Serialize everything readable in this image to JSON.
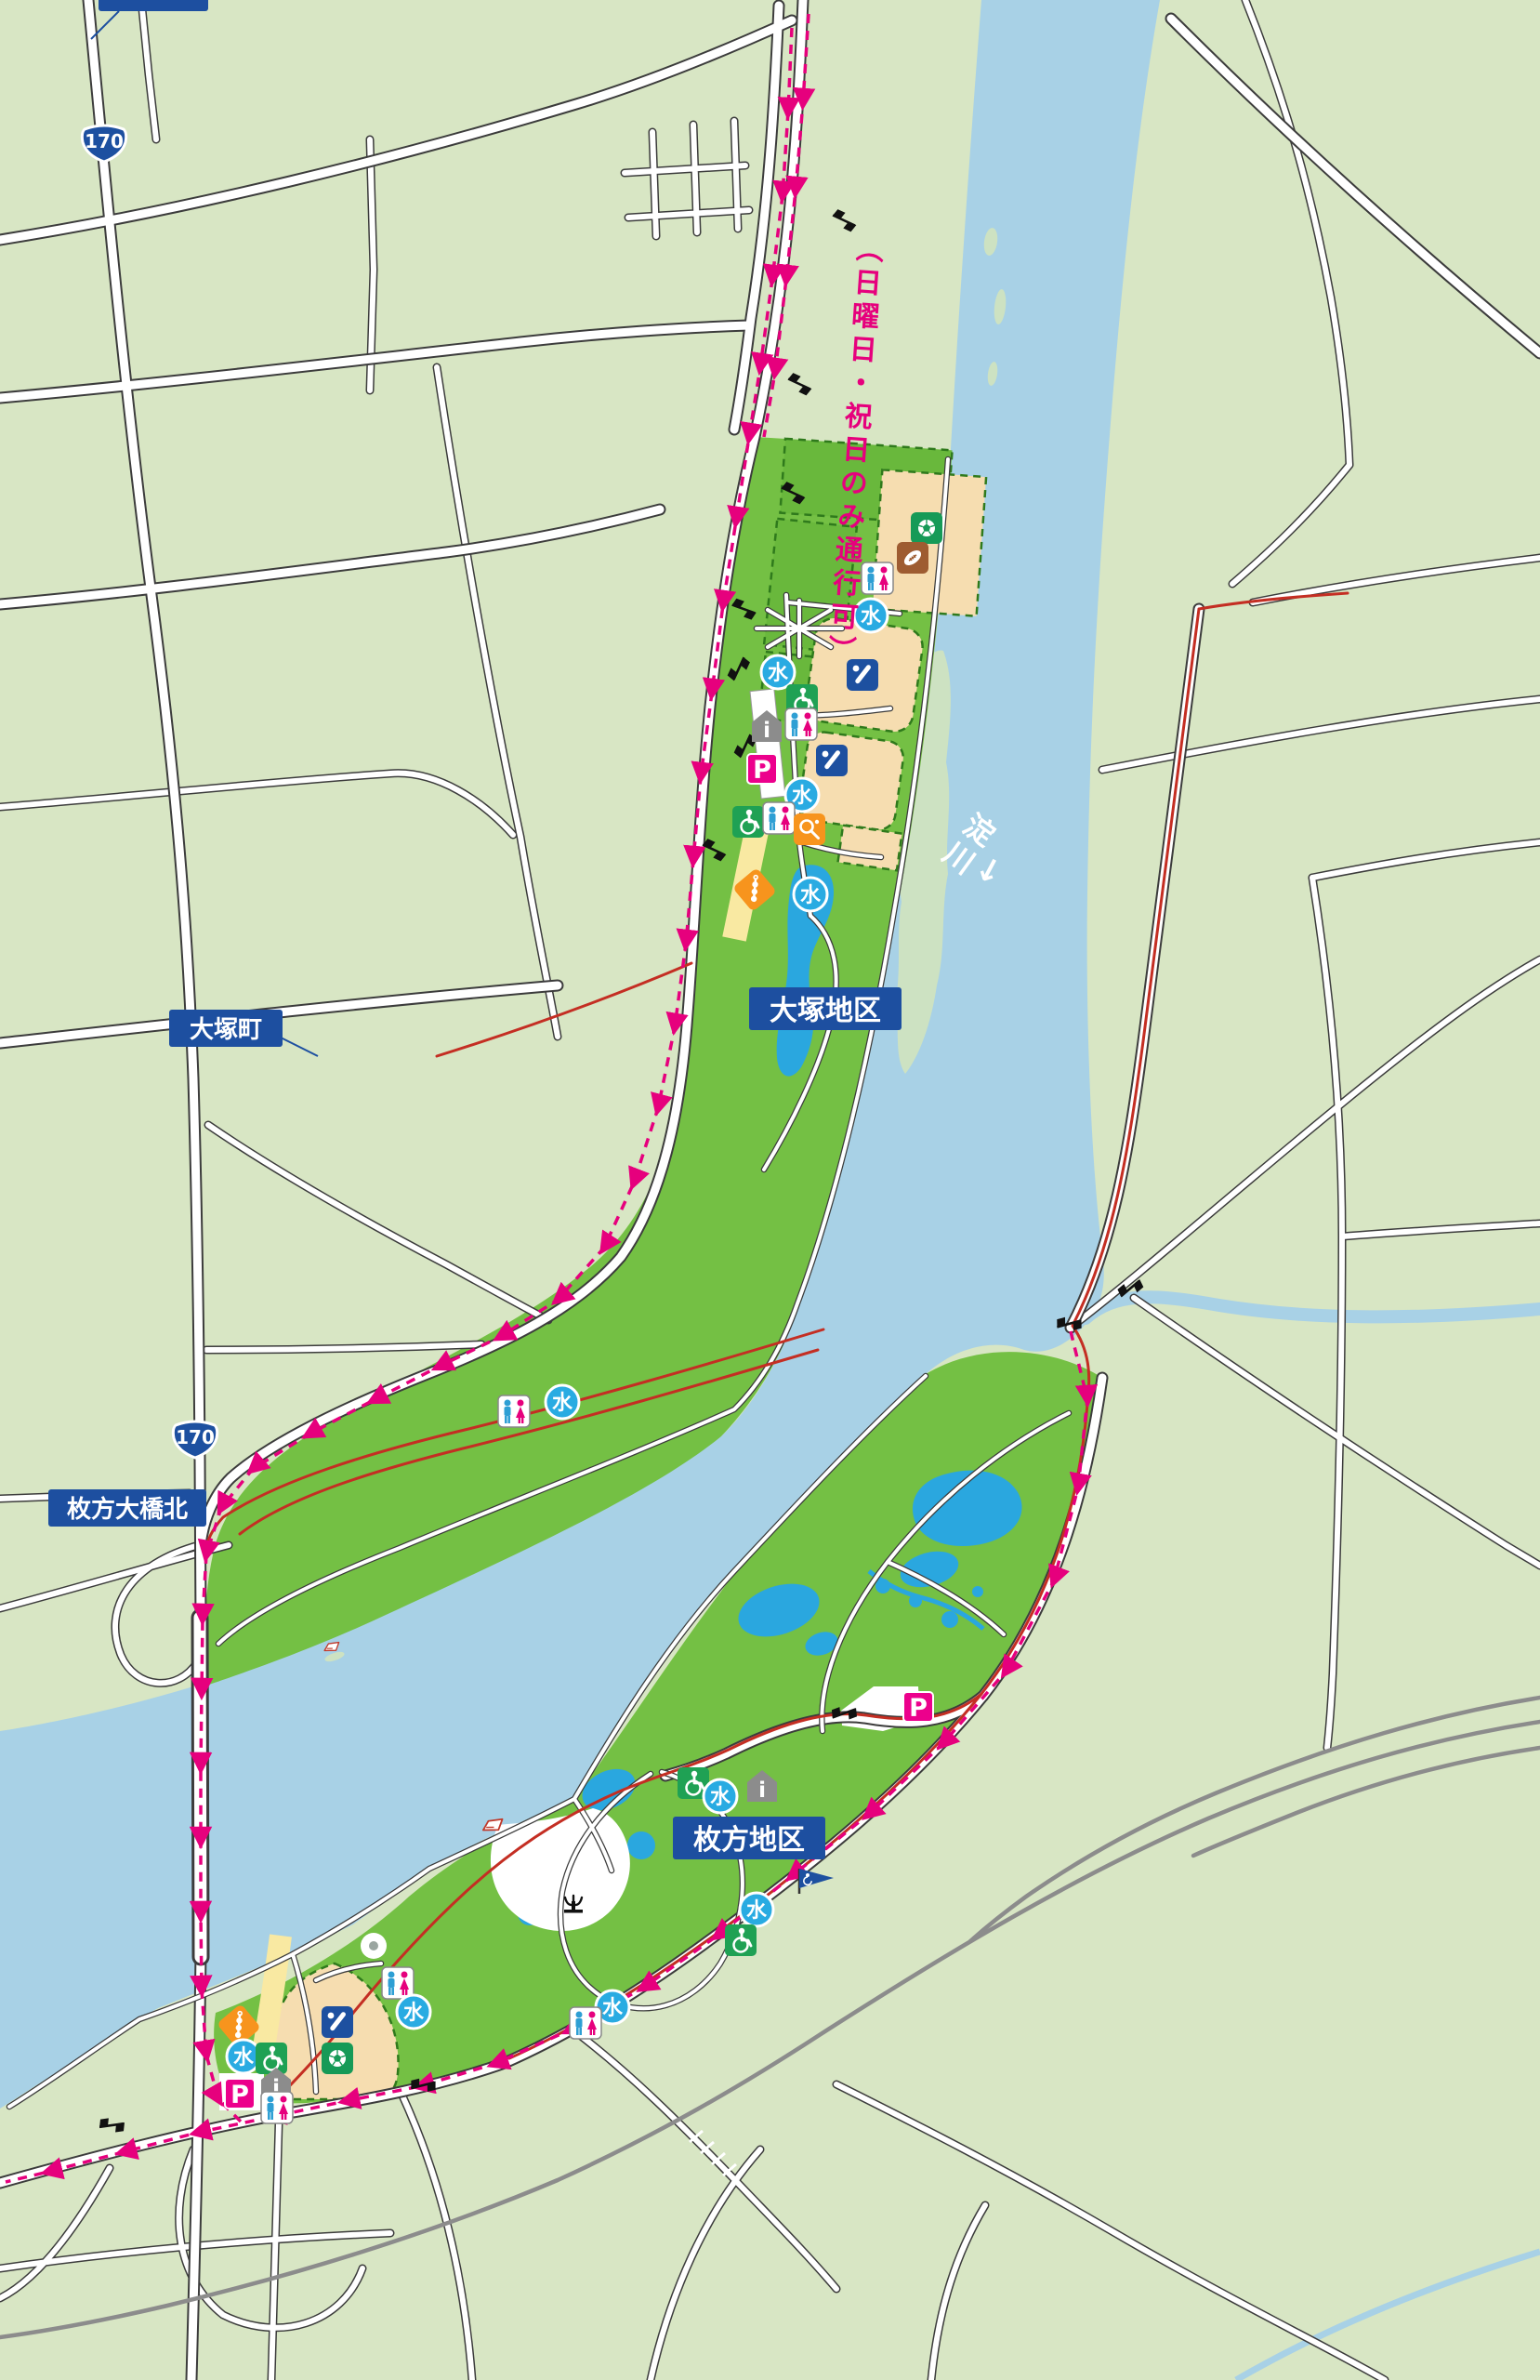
{
  "labels": {
    "top_clipped": "",
    "otsuka_cho": "大塚町",
    "otsuka_district": "大塚地区",
    "hirakata_ohashi_kita": "枚方大橋北",
    "hirakata_district": "枚方地区",
    "river_name": "淀川",
    "river_flow_arrow": "↓",
    "route_restriction_note": "（日曜日・祝日のみ通行可）"
  },
  "route_shield": {
    "number": "170"
  },
  "icon_glyphs": {
    "water": "水",
    "parking": "P",
    "information": "i"
  },
  "colors": {
    "land": "#d8e6c4",
    "park_green": "#74c044",
    "river_blue": "#a8d1e6",
    "pond_blue": "#2aa7df",
    "field_tan": "#f6ddb0",
    "road_white": "#ffffff",
    "cycling_route_pink": "#e6007d",
    "trail_red": "#c42e23",
    "railway_gray": "#8c8c8c",
    "label_bg_blue": "#1d4fa0",
    "path_yellow": "#f9e9a2",
    "sandbar_green": "#cde2c2"
  },
  "facility_icon_names": [
    "water-fountain",
    "toilet",
    "parking",
    "wheelchair-accessible",
    "information",
    "baseball-field",
    "soccer-field",
    "rugby-field",
    "tennis-court",
    "barbecue-area",
    "fountain",
    "accessible-route-flag",
    "boat-launch",
    "gate-barrier",
    "railroad-crossing"
  ]
}
